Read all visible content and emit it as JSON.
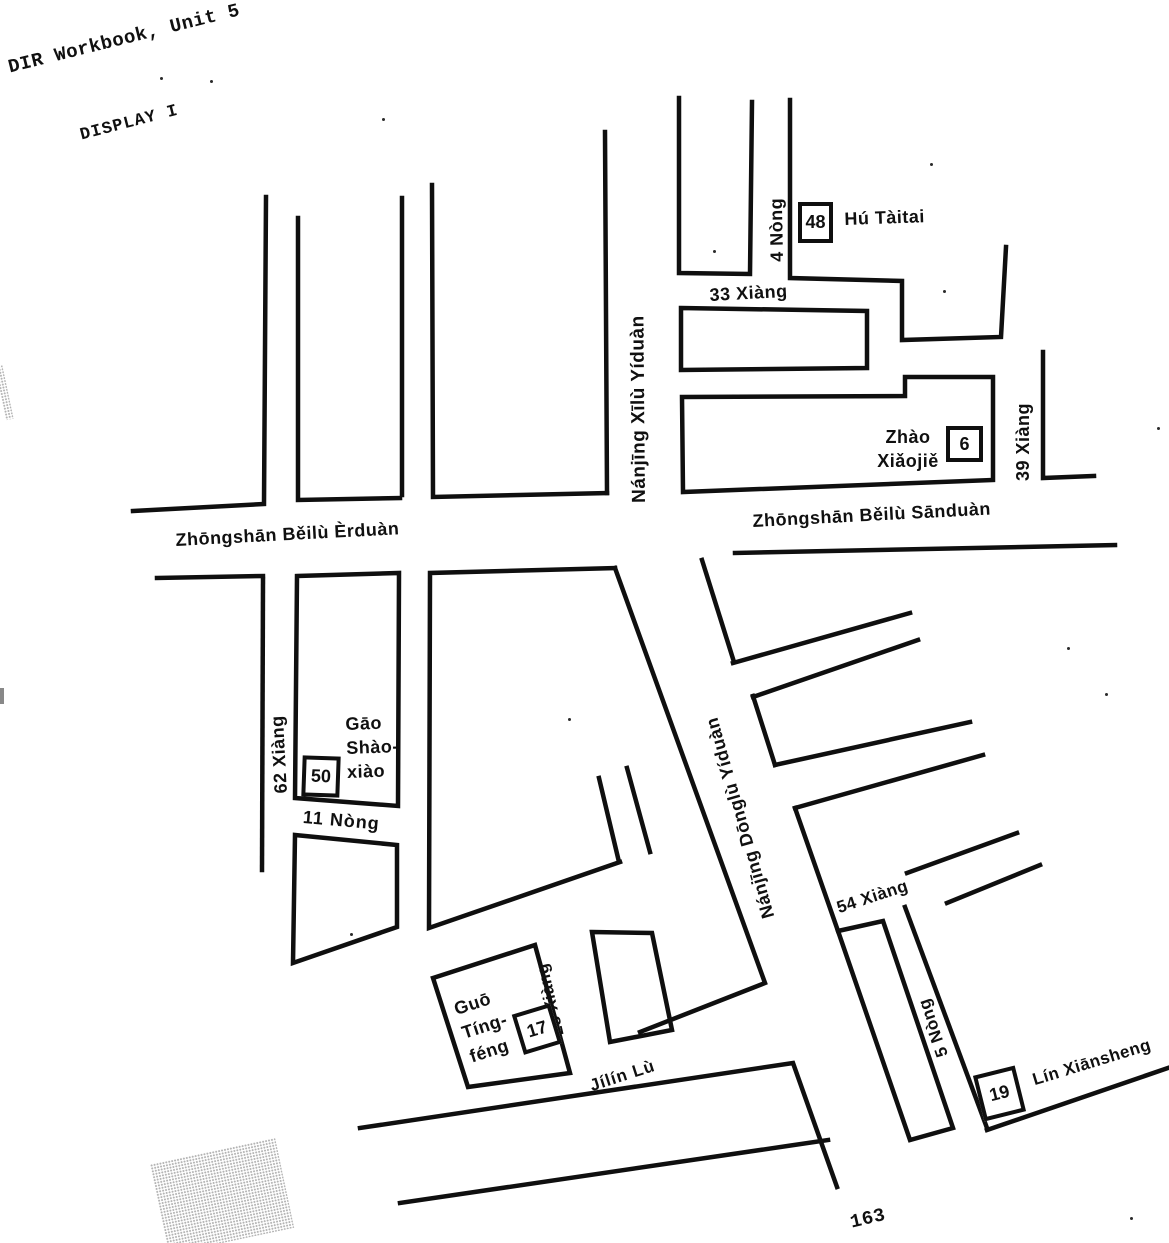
{
  "header": {
    "workbook_title": "DIR Workbook, Unit 5",
    "display_label": "DISPLAY I"
  },
  "map": {
    "streets": {
      "zhongshan_erduan": "Zhōngshān Běilù Èrduàn",
      "zhongshan_sanduan": "Zhōngshān Běilù Sānduàn",
      "nanjing_xilu": "Nánjīng Xīlù Yíduàn",
      "nanjing_donglu": "Nánjīng Dōnglù Yíduàn",
      "jilin_lu": "Jílín Lù",
      "xiang_33": "33 Xiàng",
      "xiang_39": "39 Xiàng",
      "xiang_62": "62 Xiàng",
      "xiang_54": "54 Xiàng",
      "xiang_28": "28 Xiàng",
      "nong_4": "4 Nòng",
      "nong_11": "11 Nòng",
      "nong_5": "5 Nòng"
    },
    "markers": [
      {
        "number": "48",
        "name": "Hú Tàitai"
      },
      {
        "number": "6",
        "name": "Zhào Xiǎojiě",
        "name_lines": [
          "Zhào",
          "Xiǎojiě"
        ]
      },
      {
        "number": "50",
        "name": "Gāo Shàoxiào",
        "name_lines": [
          "Gāo",
          "Shào-",
          "xiào"
        ]
      },
      {
        "number": "17",
        "name": "Guō Tíngféng",
        "name_lines": [
          "Guō",
          "Tíng-",
          "féng"
        ]
      },
      {
        "number": "19",
        "name": "Lín Xiānsheng"
      }
    ]
  },
  "footer": {
    "page_number": "163"
  }
}
